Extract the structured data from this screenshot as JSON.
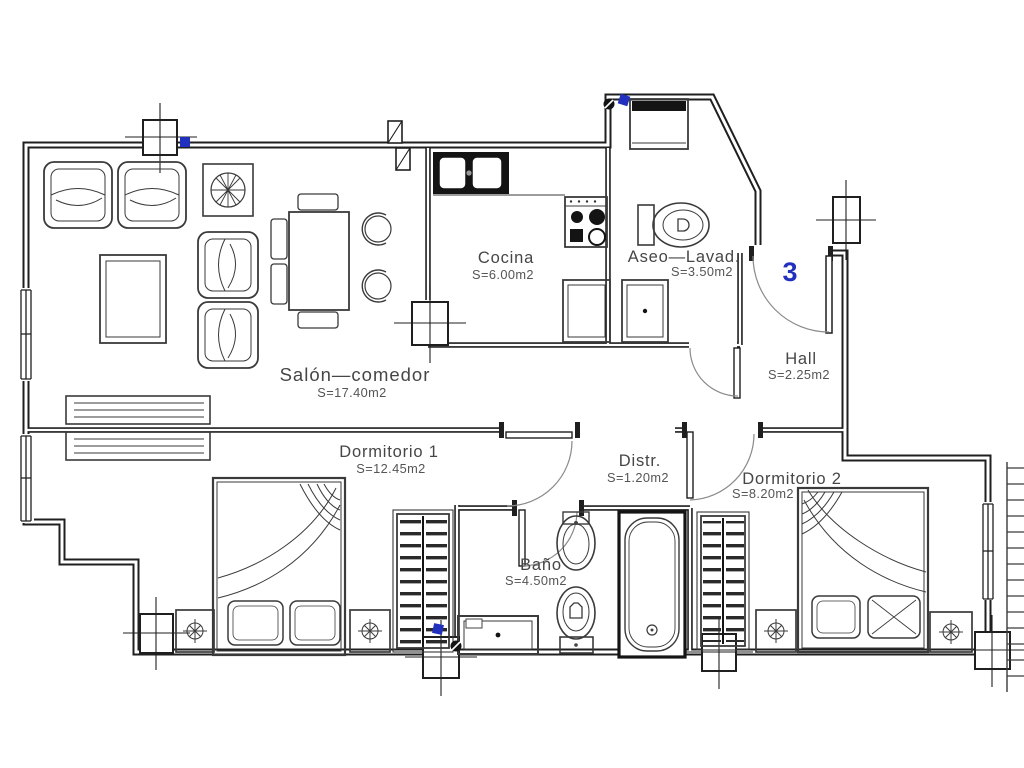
{
  "plan": {
    "unit_number": "3",
    "rooms": [
      {
        "name": "Salón—comedor",
        "area": "S=17.40m2"
      },
      {
        "name": "Cocina",
        "area": "S=6.00m2"
      },
      {
        "name": "Aseo—Lavad.",
        "area": "S=3.50m2"
      },
      {
        "name": "Hall",
        "area": "S=2.25m2"
      },
      {
        "name": "Dormitorio  1",
        "area": "S=12.45m2"
      },
      {
        "name": "Distr.",
        "area": "S=1.20m2"
      },
      {
        "name": "Dormitorio  2",
        "area": "S=8.20m2"
      },
      {
        "name": "Baño",
        "area": "S=4.50m2"
      }
    ],
    "colors": {
      "wall": "#1f1f1f",
      "label": "#464646",
      "accent_blue": "#2230c0"
    }
  }
}
